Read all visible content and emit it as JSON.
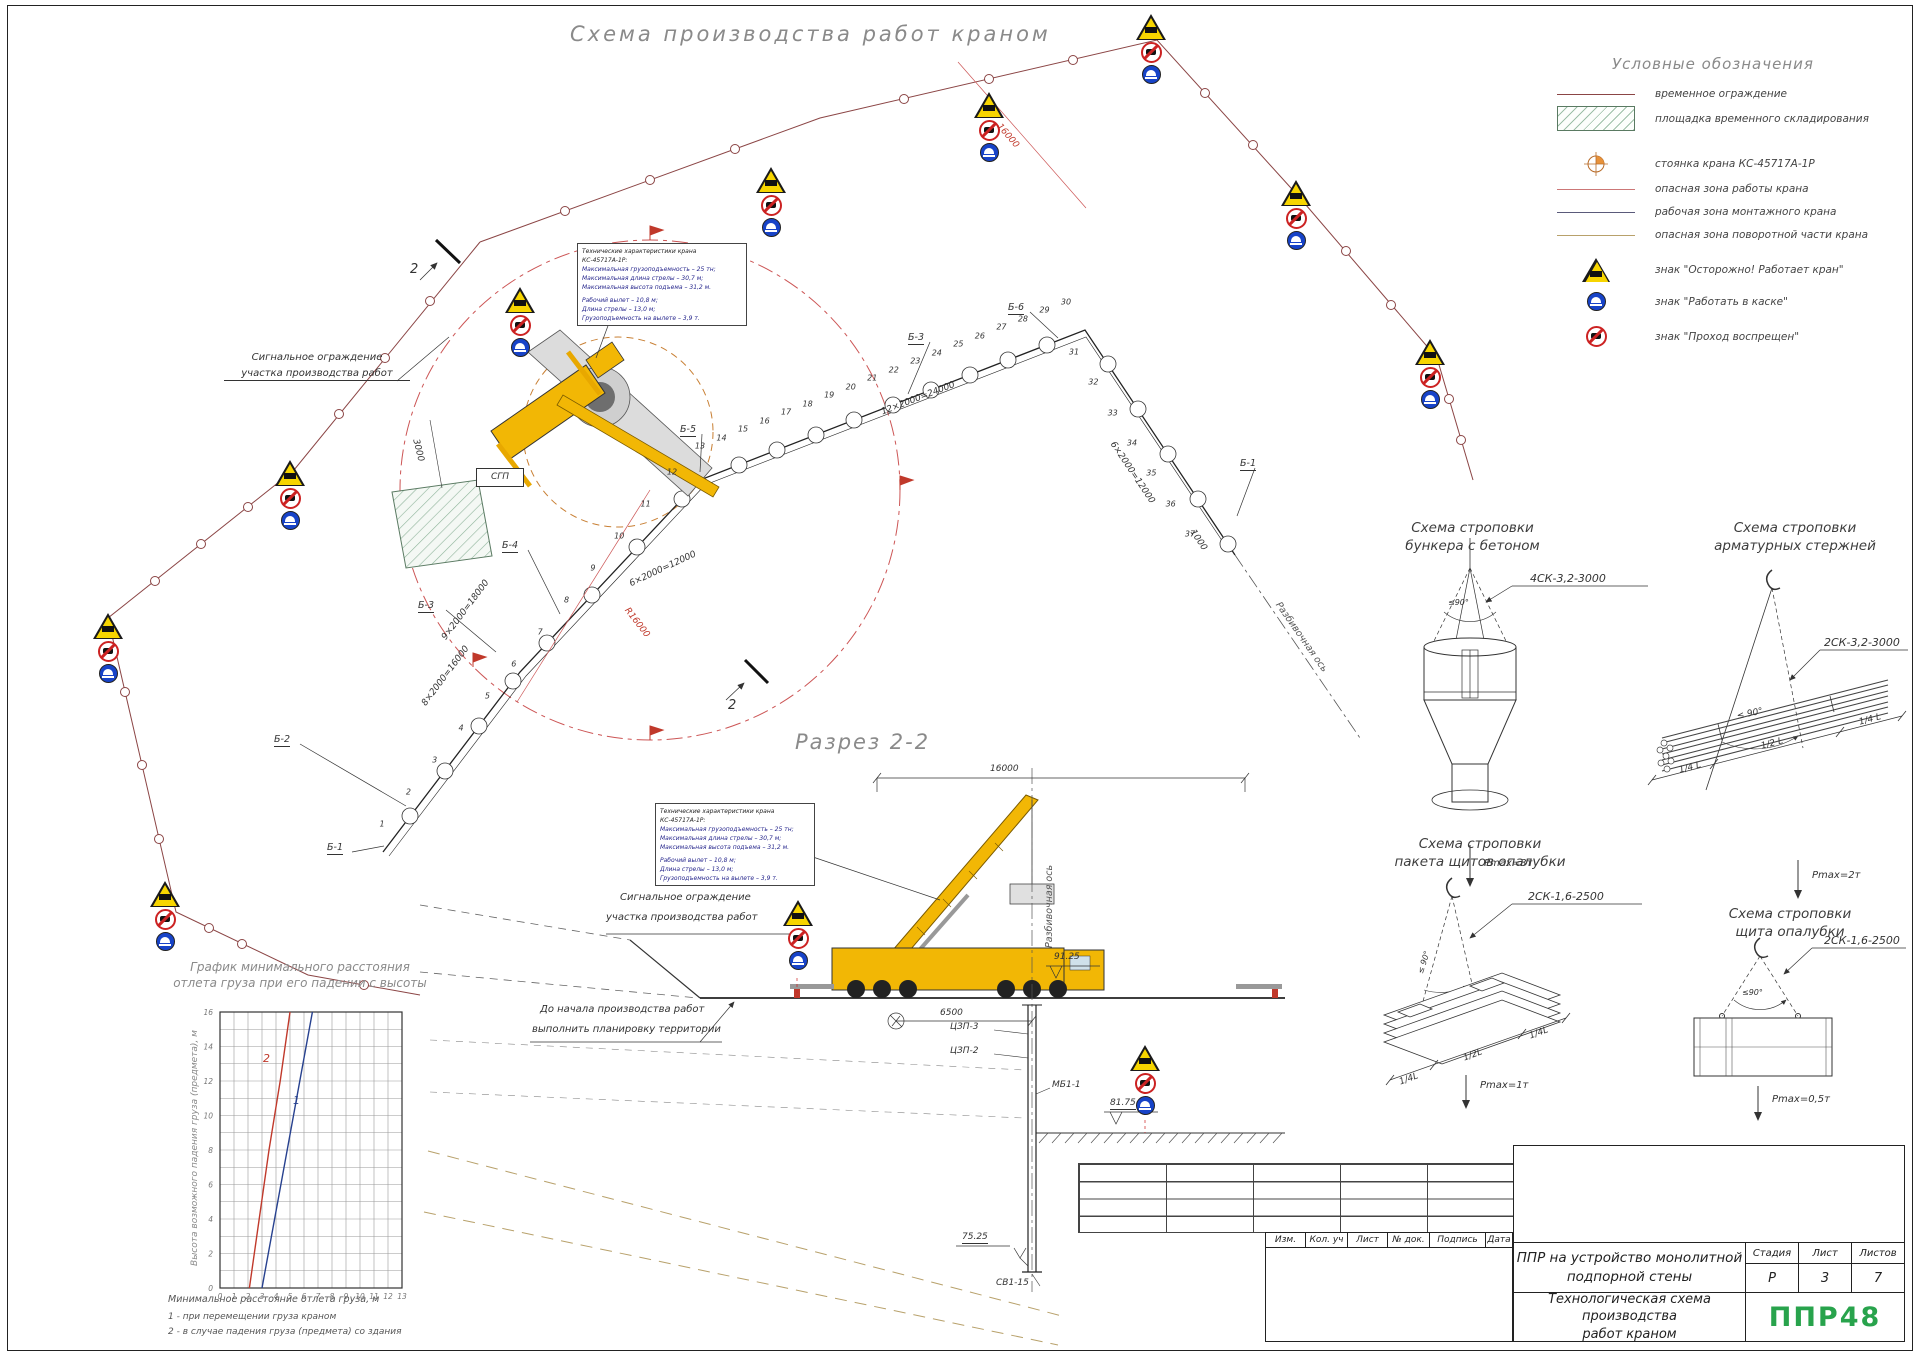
{
  "page": {
    "title": "Схема производства работ краном"
  },
  "legend": {
    "title": "Условные обозначения",
    "items": [
      {
        "symbol": "temp-fence-line",
        "label": "временное ограждение"
      },
      {
        "symbol": "storage-hatch",
        "label": "площадка временного складирования"
      },
      {
        "symbol": "crane-parking-mark",
        "label": "стоянка крана КС-45717А-1Р"
      },
      {
        "symbol": "danger-zone-line",
        "label": "опасная зона работы крана"
      },
      {
        "symbol": "work-zone-line",
        "label": "рабочая зона монтажного крана"
      },
      {
        "symbol": "slew-zone-line",
        "label": "опасная зона поворотной части крана"
      },
      {
        "symbol": "crane-warning-sign",
        "label": "знак \"Осторожно! Работает кран\""
      },
      {
        "symbol": "helmet-sign",
        "label": "знак \"Работать в каске\""
      },
      {
        "symbol": "no-entry-sign",
        "label": "знак \"Проход воспрещен\""
      }
    ]
  },
  "tech_specs": {
    "line1": "Технические характеристики крана КС-45717А-1Р:",
    "line2": "Максимальная грузоподъемность – 25 тн;",
    "line3": "Максимальная длина стрелы – 30,7 м;",
    "line4": "Максимальная высота подъема – 31,2 м.",
    "line5": "Рабочий вылет – 10,8 м;",
    "line6": "Длина стрелы – 13,0 м;",
    "line7": "Грузоподъемность на вылете – 3,9 т."
  },
  "plan": {
    "signal_fence_l1": "Сигнальное ограждение",
    "signal_fence_l2": "участка производства работ",
    "section_mark": "2",
    "sgp": "СГП",
    "razb_axis": "Разбивочная ось",
    "dim_9x2000": "9×2000=18000",
    "dim_8x2000": "8×2000=16000",
    "dim_6x2000": "6×2000=12000",
    "dim_12x2000": "12×2000=24000",
    "dim_6x2000_b": "6×2000=12000",
    "dim_1000": "1000",
    "dim_3000": "3000",
    "dim_r16000": "R16000",
    "dim_16000": "16000",
    "axis_b1": "Б-1",
    "axis_b2": "Б-2",
    "axis_b3": "Б-3",
    "axis_b4": "Б-4",
    "axis_b5": "Б-5",
    "axis_b6": "Б-6",
    "axis_b3b": "Б-3",
    "axis_b1b": "Б-1",
    "numbers_a": [
      "1",
      "2",
      "3",
      "4",
      "5",
      "6",
      "7",
      "8",
      "9",
      "10",
      "11",
      "12"
    ],
    "numbers_b": [
      "13",
      "14",
      "15",
      "16",
      "17",
      "18",
      "19",
      "20",
      "21",
      "22",
      "23",
      "24",
      "25",
      "26",
      "27",
      "28",
      "29",
      "30"
    ],
    "numbers_c": [
      "31",
      "32",
      "33",
      "34",
      "35",
      "36",
      "37"
    ]
  },
  "section": {
    "title": "Разрез 2-2",
    "dim_16000": "16000",
    "dim_6500": "6500",
    "elev_9125": "91.25",
    "elev_8175": "81.75",
    "elev_7525": "75.25",
    "lbl_czp3": "ЦЗП-3",
    "lbl_czp2": "ЦЗП-2",
    "lbl_mb11": "МБ1-1",
    "lbl_sv115": "СВ1-15",
    "razb_axis": "Разбивочная ось",
    "fence_l1": "Сигнальное ограждение",
    "fence_l2": "участка производства работ",
    "note_l1": "До начала производства работ",
    "note_l2": "выполнить планировку территории",
    "mark": "2"
  },
  "rigging": {
    "s1": {
      "t1": "Схема строповки",
      "t2": "бункера с бетоном",
      "sling": "4СК-3,2-3000",
      "angle": "≤90°",
      "pmax": "Pmax=3т"
    },
    "s2": {
      "t1": "Схема строповки",
      "t2": "арматурных стержней",
      "sling": "2СК-3,2-3000",
      "angle": "≤ 90°",
      "pmax": "Pmax=2т",
      "d1": "1/4 L",
      "d2": "1/2 L",
      "d3": "1/4 L"
    },
    "s3": {
      "t1": "Схема строповки",
      "t2": "пакета щитов опалубки",
      "sling": "2СК-1,6-2500",
      "angle": "≤ 90°",
      "pmax": "Pmax=1т",
      "d1": "1/4L",
      "d2": "1/2L",
      "d3": "1/4L"
    },
    "s4": {
      "t1": "Схема строповки",
      "t2": "щита опалубки",
      "sling": "2СК-1,6-2500",
      "angle": "≤90°",
      "pmax": "Pmax=0,5т"
    }
  },
  "graph": {
    "title_l1": "График минимального расстояния",
    "title_l2": "отлета груза при его падении с высоты",
    "ylabel": "Высота возможного падения груза (предмета), м",
    "xlabel": "Минимальное расстояние отлета груза, м",
    "note1": "1 - при перемещении груза краном",
    "note2": "2 - в случае падения груза (предмета) со здания",
    "curve1": "1",
    "curve2": "2"
  },
  "chart_data": {
    "type": "line",
    "title": "График минимального расстояния отлета груза при его падении с высоты",
    "xlabel": "Минимальное расстояние отлета груза, м",
    "ylabel": "Высота возможного падения груза (предмета), м",
    "xlim": [
      0,
      13
    ],
    "ylim": [
      0,
      16
    ],
    "x_ticks": [
      0,
      1,
      2,
      3,
      4,
      5,
      6,
      7,
      8,
      9,
      10,
      11,
      12,
      13
    ],
    "y_ticks": [
      0,
      2,
      4,
      6,
      8,
      10,
      12,
      14,
      16
    ],
    "grid": true,
    "legend_position": "none",
    "series": [
      {
        "name": "1 - при перемещении груза краном",
        "color": "#27418f",
        "x": [
          3.0,
          3.9,
          4.8,
          5.7,
          6.6
        ],
        "y": [
          0,
          4,
          8,
          12,
          16
        ]
      },
      {
        "name": "2 - в случае падения груза (предмета) со здания",
        "color": "#c0392b",
        "x": [
          2.1,
          2.8,
          3.5,
          4.3,
          5.0
        ],
        "y": [
          0,
          4,
          8,
          12,
          16
        ]
      }
    ]
  },
  "titleblock": {
    "h_izm": "Изм.",
    "h_kol": "Кол. уч",
    "h_list": "Лист",
    "h_doc": "№ док.",
    "h_podp": "Подпись",
    "h_data": "Дата",
    "project_l1": "ППР на устройство монолитной",
    "project_l2": "подпорной стены",
    "h_stage": "Стадия",
    "h_sheet": "Лист",
    "h_sheets": "Листов",
    "stage": "Р",
    "sheet": "3",
    "sheets": "7",
    "doc_l1": "Технологическая схема производства",
    "doc_l2": "работ краном",
    "logo": "ППР48"
  },
  "colors": {
    "danger_red": "#cc5555",
    "fence": "#8b4545",
    "crane_yellow": "#f2b705",
    "slew_zone": "#c87f33",
    "logo_green": "#28a34c",
    "spec_navy": "#26268c"
  }
}
